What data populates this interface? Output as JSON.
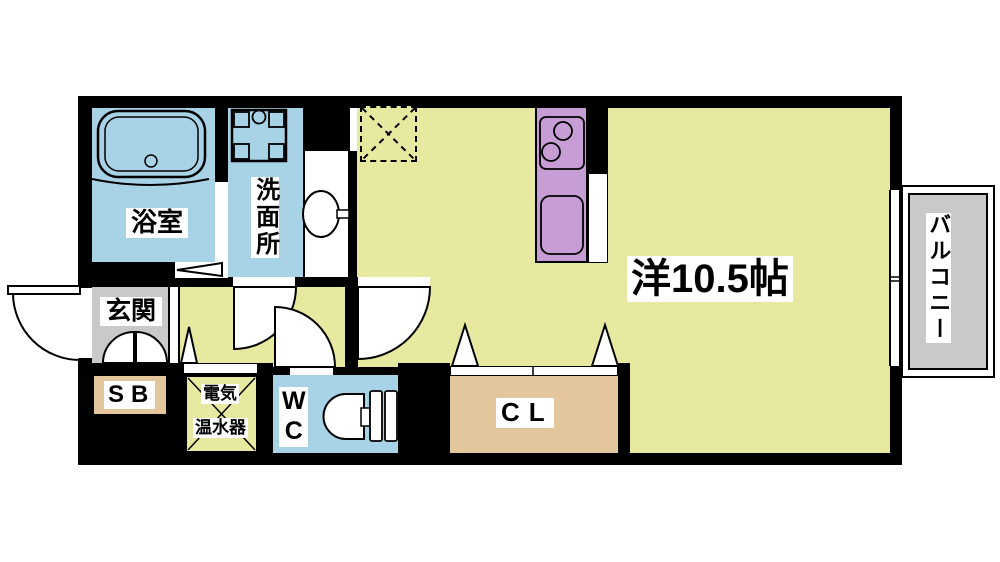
{
  "plan": {
    "bath_label": "浴室",
    "washroom_label": "洗面所",
    "entrance_label": "玄関",
    "shoebox_label": "SB",
    "heater_label_1": "電気",
    "heater_label_2": "温水器",
    "wc_label": "WC",
    "closet_label": "CL",
    "main_room_label": "洋10.5帖",
    "balcony_label": "バルコニー"
  },
  "colors": {
    "wall": "#000000",
    "room_yellow": "#e8e9a0",
    "water_blue": "#a8d2e6",
    "kitchen_purple": "#c79dd6",
    "entrance_grey": "#c9c9c9",
    "balcony_grey": "#c9c9c9",
    "storage_tan": "#e3c69c"
  },
  "icons": {
    "bathtub": "bathtub-icon",
    "washer_pan": "washing-machine-pan-icon",
    "sink": "wash-basin-icon",
    "stove": "stove-icon",
    "kitchen_sink": "kitchen-sink-icon",
    "toilet": "toilet-icon",
    "refrigerator": "refrigerator-placement-icon",
    "door_arcs": "door-swing-icon",
    "fold_triangles": "folding-door-icon"
  }
}
